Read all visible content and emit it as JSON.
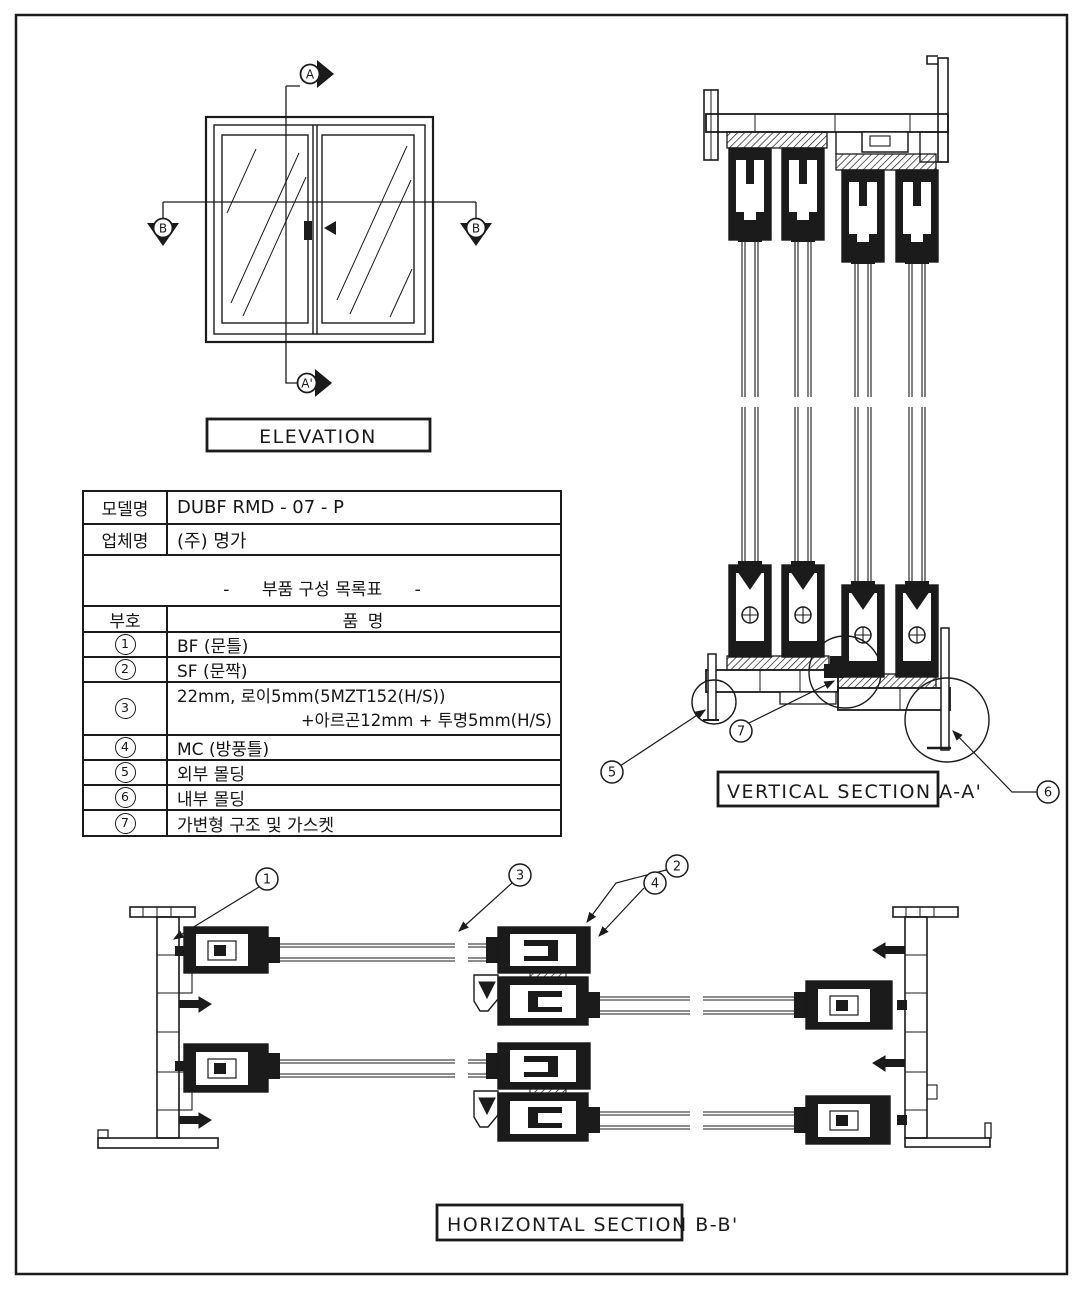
{
  "sheet": {
    "elevation_label": "ELEVATION",
    "vertical_section_label": "VERTICAL SECTION A-A'",
    "horizontal_section_label": "HORIZONTAL SECTION B-B'"
  },
  "markers": {
    "a_top": "A",
    "a_bottom": "A'",
    "b_left": "B",
    "b_right": "B"
  },
  "callouts": {
    "c1": "1",
    "c2": "2",
    "c3": "3",
    "c4": "4",
    "c5": "5",
    "c6": "6",
    "c7": "7"
  },
  "table": {
    "model_label": "모델명",
    "model_value": "DUBF RMD - 07 - P",
    "vendor_label": "업체명",
    "vendor_value": "(주) 명가",
    "parts_list_title": "-      부품 구성 목록표      -",
    "header_symbol": "부호",
    "header_name": "품  명",
    "rows": [
      {
        "num": "1",
        "name": "BF (문틀)"
      },
      {
        "num": "2",
        "name": "SF (문짝)"
      },
      {
        "num": "3",
        "name": "22mm, 로이5mm(5MZT152(H/S))",
        "name2": "+아르곤12mm + 투명5mm(H/S)"
      },
      {
        "num": "4",
        "name": "MC (방풍틀)"
      },
      {
        "num": "5",
        "name": "외부 몰딩"
      },
      {
        "num": "6",
        "name": "내부 몰딩"
      },
      {
        "num": "7",
        "name": "가변형 구조 및 가스켓"
      }
    ]
  }
}
